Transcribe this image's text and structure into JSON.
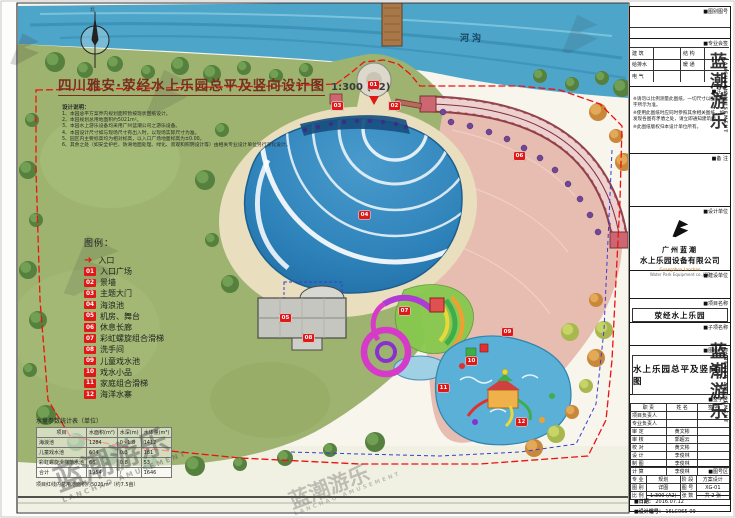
{
  "sheet": {
    "drawing_title": "四川雅安·荥经水上乐园总平及竖向设计图",
    "drawing_scale": "1:300 (A2)",
    "river_label": "河沟",
    "north_label": "北"
  },
  "notes": {
    "heading": "设计说明：",
    "items": [
      "1、本园总平方案界内规划面积暂按现状图纸设计。",
      "2、本园规划总用地面积约5021m²。",
      "3、本园水上游乐设备均采用广州蓝潮公司之游乐设备。",
      "4、本园设计尺寸如与现场尺寸有出入时，以现场实际尺寸为准。",
      "5、园区内主要标高均为相对标高，以入口广场地面标高为±0.00。",
      "6、其余之处（如安全护栏、防滑地面处理、绿化、景观和照明设计等）由相关专业设计单位另行深化设计。"
    ]
  },
  "legend": {
    "heading": "图例：",
    "entrance_label": "入口",
    "items": [
      {
        "num": "01",
        "label": "入口广场"
      },
      {
        "num": "02",
        "label": "景墙"
      },
      {
        "num": "03",
        "label": "主题大门"
      },
      {
        "num": "04",
        "label": "海浪池"
      },
      {
        "num": "05",
        "label": "机房、舞台"
      },
      {
        "num": "06",
        "label": "休息长廊"
      },
      {
        "num": "07",
        "label": "彩虹螺旋组合滑梯"
      },
      {
        "num": "08",
        "label": "洗手间"
      },
      {
        "num": "09",
        "label": "儿童戏水池"
      },
      {
        "num": "10",
        "label": "戏水小品"
      },
      {
        "num": "11",
        "label": "家庭组合滑梯"
      },
      {
        "num": "12",
        "label": "海洋水寨"
      }
    ]
  },
  "stats_table": {
    "title": "水量参数统计表（单位）",
    "columns": [
      "项目",
      "水面积(m²)",
      "水深(m)",
      "水体量(m³)"
    ],
    "rows": [
      [
        "海浪池",
        "1284",
        "0~1.8",
        "1412"
      ],
      [
        "儿童戏水池",
        "604",
        "0.3",
        "181"
      ],
      [
        "彩虹螺旋滑梯落水池",
        "66",
        "0.8",
        "53"
      ],
      [
        "合计",
        "1954",
        "/",
        "1646"
      ]
    ],
    "footnote": "项目红线内总用地面积约5021m²（约7.5亩）"
  },
  "plan": {
    "markers": [
      "01",
      "02",
      "03",
      "04",
      "05",
      "06",
      "07",
      "08",
      "09",
      "10",
      "11",
      "12"
    ]
  },
  "title_block": {
    "sheetno_label": "■图别图号",
    "cosign_label": "■专业会签",
    "cosign_cells": [
      "建 筑",
      "结 构",
      "给排水",
      "暖 通",
      "电 气"
    ],
    "notice_label": "■注 意",
    "notice_items": [
      "※请勿以比例测量此图纸，一切尺寸以图内数字所示为准。",
      "※使用此图纸时应同时参照其余相关图纸，如发现各图有矛盾之处，请立即通知建筑师。",
      "※此图纸版权归本设计单位所有。"
    ],
    "remark_label": "■备 注",
    "designer_label": "■设计单位",
    "company_cn_1": "广州蓝潮",
    "company_cn_2": "水上乐园设备有限公司",
    "company_en_1": "Guangzhou Lanchao",
    "company_en_2": "Water Park Equipment co.,LTD",
    "builder_label": "■建设单位",
    "project_label": "■项目名称",
    "project_name": "荥经水上乐园",
    "subproject_label": "■子项名称",
    "drawing_label": "■图纸名称",
    "drawing_name": "水上乐园总平及竖向图",
    "sign_label": "■签字区",
    "sign_columns": [
      "职 责",
      "姓 名",
      "签 名"
    ],
    "sign_rows": [
      {
        "role": "项目负责人",
        "name": "",
        "sig": ""
      },
      {
        "role": "专业负责人",
        "name": "",
        "sig": ""
      },
      {
        "role": "审 定",
        "name": "黄文彬",
        "sig": ""
      },
      {
        "role": "审 核",
        "name": "郭超云",
        "sig": ""
      },
      {
        "role": "校 对",
        "name": "黄文彬",
        "sig": ""
      },
      {
        "role": "设 计",
        "name": "李俊林",
        "sig": ""
      },
      {
        "role": "制 图",
        "name": "李俊林",
        "sig": ""
      },
      {
        "role": "计 算",
        "name": "李俊林",
        "sig": ""
      }
    ],
    "sheetinfo_label": "■图号区",
    "info_rows": [
      {
        "k1": "专 业",
        "v1": "规划",
        "k2": "阶 段",
        "v2": "方案设计"
      },
      {
        "k1": "图 别",
        "v1": "详图",
        "k2": "图 号",
        "v2": "XG-01"
      },
      {
        "k1": "比 例",
        "v1": "1:300 (A2)",
        "k2": "张 数",
        "v2": "共 2 张"
      }
    ],
    "date_label": "■日期：",
    "date_value": "2016.07.12",
    "serial_label": "■设计编号：",
    "serial_value": "16LC065-09"
  },
  "watermark": {
    "cn": "蓝潮游乐",
    "en": "LANCHAO AMUSEMENT"
  }
}
